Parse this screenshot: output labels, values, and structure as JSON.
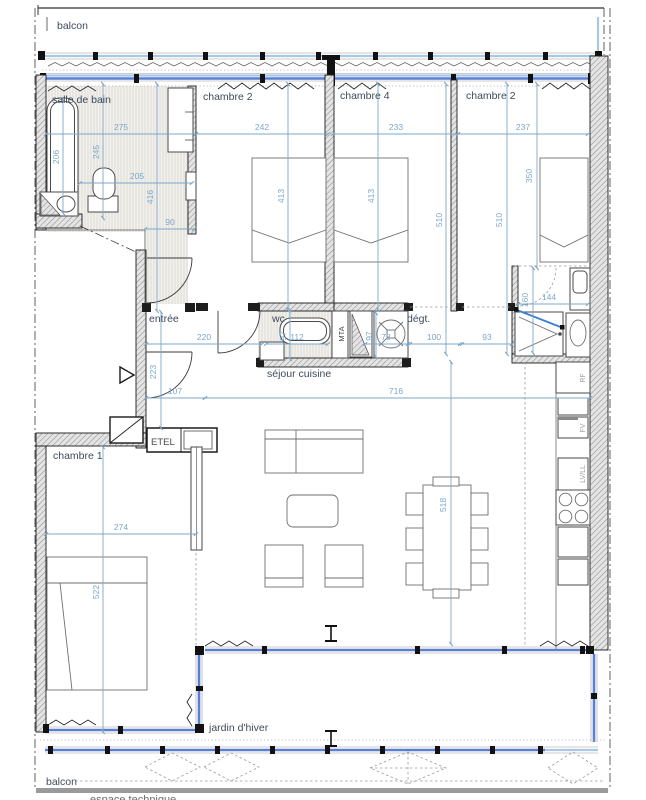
{
  "labels": {
    "balcon_top": "balcon",
    "salle_de_bain": "salle de bain",
    "chambre2_left": "chambre 2",
    "chambre4": "chambre 4",
    "chambre2_right": "chambre 2",
    "entree": "entrée",
    "wc": "wc",
    "degt": "dégt.",
    "sejour_cuisine": "séjour cuisine",
    "chambre1": "chambre 1",
    "jardin_dhiver": "jardin d'hiver",
    "balcon_bottom": "balcon",
    "espace_technique": "espace technique",
    "etel": "ETEL",
    "mta": "MTA",
    "rf": "RF",
    "fv": "FV",
    "lvll": "LV/LL"
  },
  "dims": {
    "d275": "275",
    "d242": "242",
    "d233": "233",
    "d237": "237",
    "d205": "205",
    "d90": "90",
    "d206": "206",
    "d245": "245",
    "d416": "416",
    "d413a": "413",
    "d413b": "413",
    "d510a": "510",
    "d510b": "510",
    "d350": "350",
    "d160": "160",
    "d144": "144",
    "d220": "220",
    "d223": "223",
    "d112": "112",
    "d97wc": "97",
    "d97m": "97",
    "d78": "78",
    "d100": "100",
    "d93": "93",
    "d107": "107",
    "d716": "716",
    "d518": "518",
    "d274": "274",
    "d522": "522"
  },
  "colors": {
    "glazing_blue": "#5b7fd0",
    "balcony_rail_blue": "#a9c7e8",
    "dimension_blue": "#7da7c9",
    "wall_dark": "#1a1a1a",
    "label_slate": "#3d4b5c"
  }
}
